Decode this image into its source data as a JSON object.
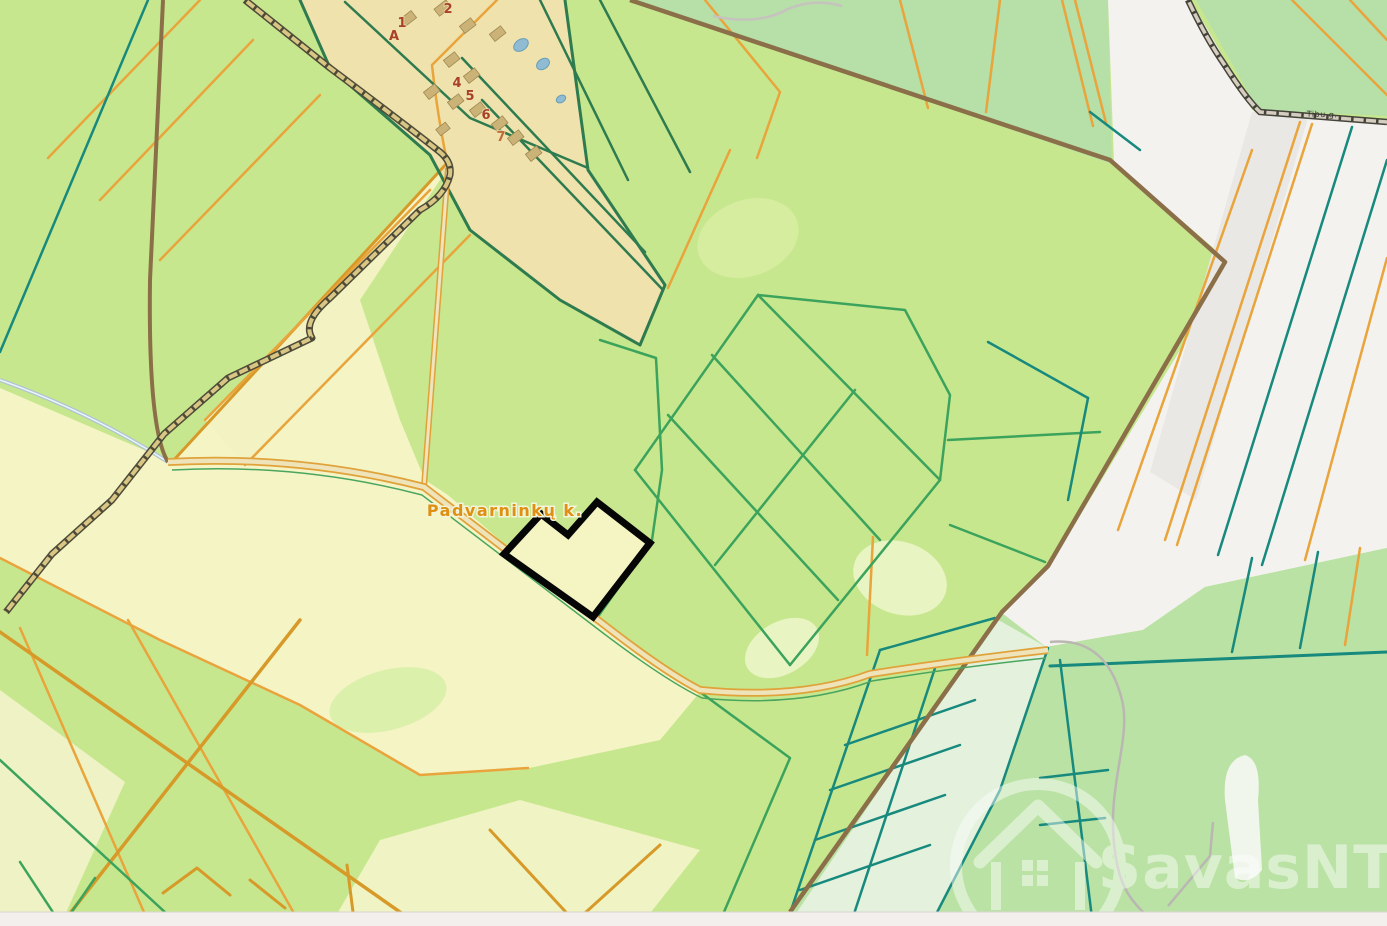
{
  "map": {
    "labels": {
      "place": "Padvarninkų k.",
      "road": "Tibu g.",
      "house_numbers": [
        "1",
        "A",
        "2",
        "4",
        "5",
        "6",
        "7"
      ]
    },
    "watermark": {
      "text": "SavasNT",
      "logo": "house-in-circle-icon"
    },
    "selected_parcel": {
      "outline_color": "#000000",
      "fill_color": "#f4f5c2"
    },
    "palette": {
      "field_green": "#c7e78e",
      "field_pale_yellow": "#f5f4c5",
      "field_sage_green": "#b7dfa8",
      "area_white": "#f3f2ef",
      "village_tan": "#efe2ad",
      "border_orange": "#e9a43c",
      "border_goldenrod": "#d79a28",
      "border_teal": "#17897d",
      "border_green": "#3ba35c",
      "border_dark_green": "#2e7b4f",
      "road_brown": "#8a6f48",
      "road_fill": "#efe3ba",
      "trail_fill": "#d9c685",
      "water_blue": "#8fbcd2",
      "label_orange": "#df9013",
      "number_red": "#a8402a",
      "watermark_white": "#ffffff",
      "bottom_bar": "#f2efec"
    }
  }
}
